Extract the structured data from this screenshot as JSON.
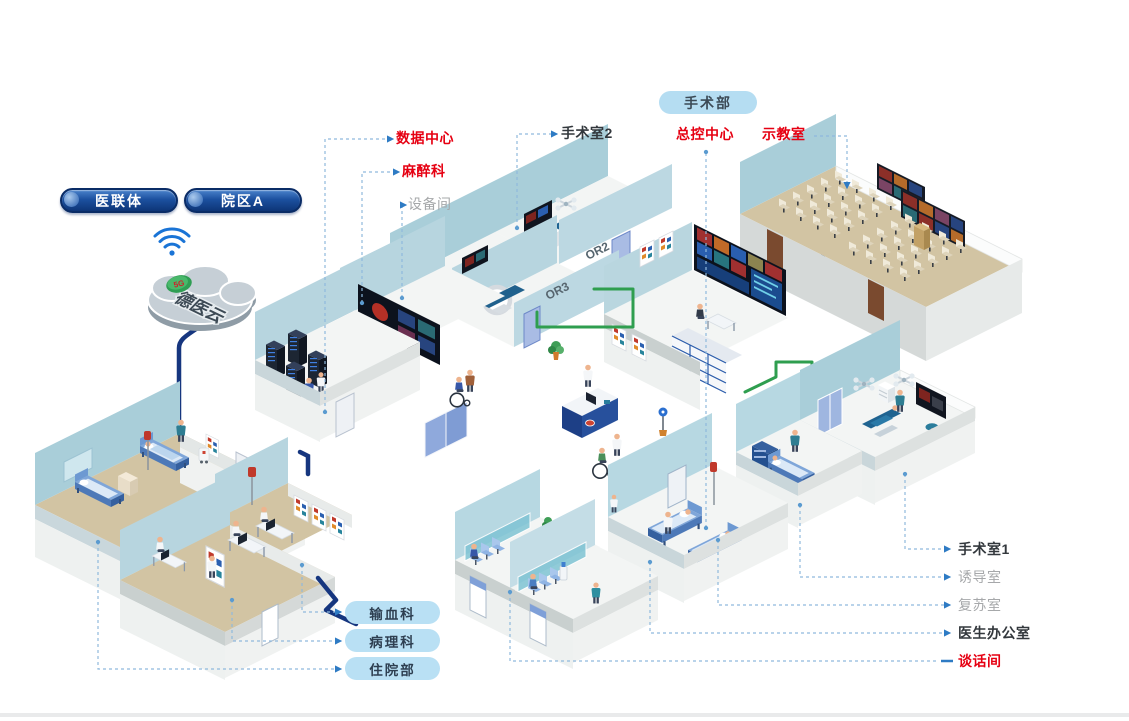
{
  "org_pills": [
    {
      "label": "医联体"
    },
    {
      "label": "院区A"
    }
  ],
  "cloud": {
    "label": "德医云",
    "badge": "5G"
  },
  "department_pill": {
    "label": "手术部"
  },
  "callouts": {
    "left": [
      {
        "label": "数据中心",
        "style": "red"
      },
      {
        "label": "麻醉科",
        "style": "red"
      },
      {
        "label": "设备间",
        "style": "gray"
      }
    ],
    "top": [
      {
        "label": "手术室2",
        "style": "dark"
      },
      {
        "label": "总控中心",
        "style": "red"
      },
      {
        "label": "示教室",
        "style": "red"
      }
    ],
    "right": [
      {
        "label": "手术室1",
        "style": "dark"
      },
      {
        "label": "诱导室",
        "style": "gray"
      },
      {
        "label": "复苏室",
        "style": "gray"
      },
      {
        "label": "医生办公室",
        "style": "dark"
      },
      {
        "label": "谈话间",
        "style": "red"
      }
    ],
    "bottom": [
      {
        "label": "输血科"
      },
      {
        "label": "病理科"
      },
      {
        "label": "住院部"
      }
    ]
  },
  "room_marks": {
    "or2": "OR2",
    "or3": "OR3"
  },
  "colors": {
    "accent_red": "#e60012",
    "pill_navy": "#12387d",
    "pill_light_blue": "#b5ddf2",
    "cable_navy": "#16367f",
    "cable_green": "#2f9e4f",
    "wall_blue": "#a9ced9",
    "floor_tan": "#d2c4a3"
  }
}
